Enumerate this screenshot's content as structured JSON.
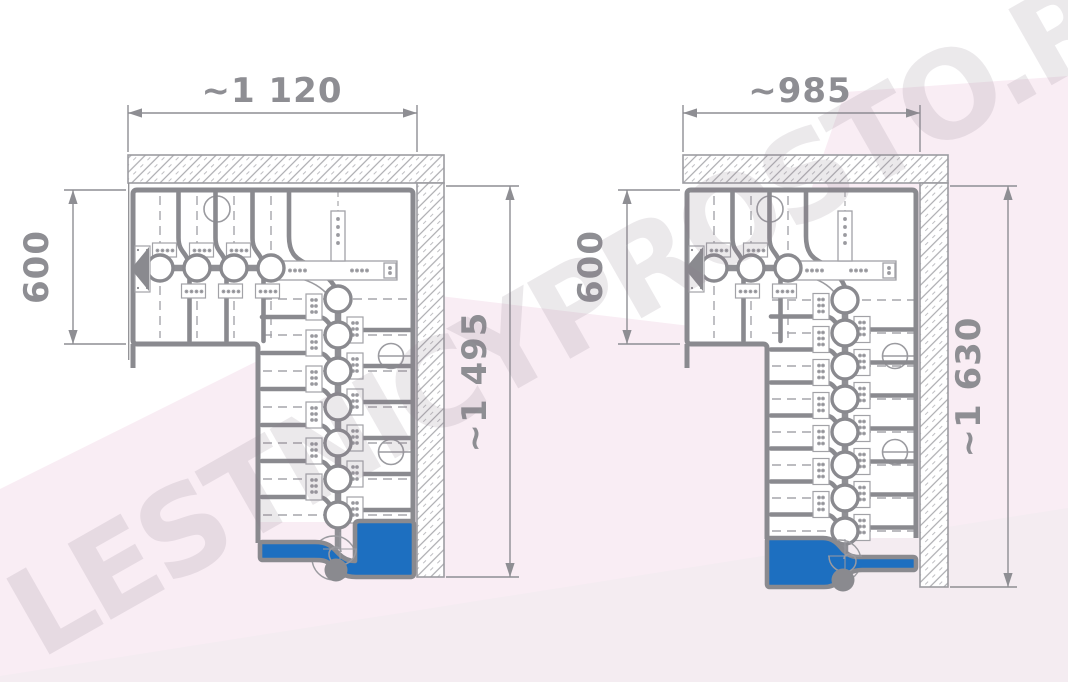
{
  "watermark": {
    "text": "LESTNICYPROSTO.RU"
  },
  "colors": {
    "accent_blue": "#1d6fc0",
    "line_gray": "#8a8a8f",
    "thin_gray": "#9b9ba0",
    "dim_text_gray": "#8e8e93",
    "hatch_gray": "#ababaf",
    "bg_pink": "#f9edf4",
    "bg_pink_light": "#f4ecf1"
  },
  "drawings": [
    {
      "name": "left-stair-plan",
      "dim_width": "~1 120",
      "dim_depth": "600",
      "dim_length": "~1 495",
      "top_steps": 4,
      "down_steps": 7
    },
    {
      "name": "right-stair-plan",
      "dim_width": "~985",
      "dim_depth": "600",
      "dim_length": "~1 630",
      "top_steps": 3,
      "down_steps": 8
    }
  ]
}
